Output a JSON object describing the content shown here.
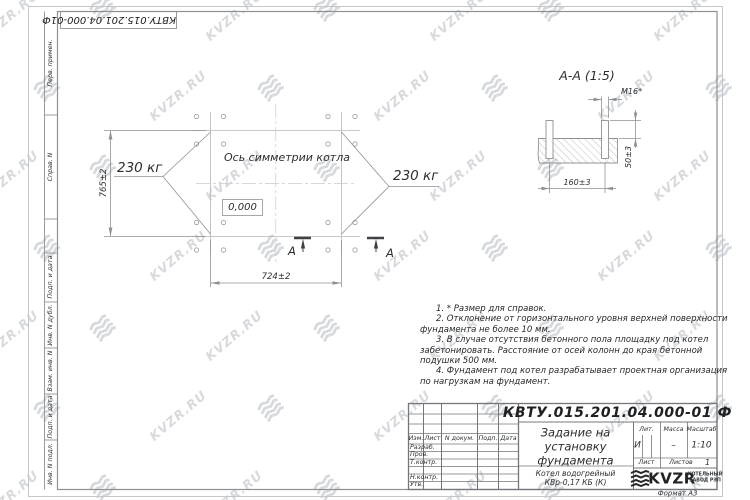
{
  "watermark": {
    "text": "KVZR.RU",
    "color": "#d7dadc"
  },
  "colors": {
    "line_gray": "#8e9296",
    "axis_gray": "#b3b7bb",
    "text_dark": "#2b2d2f"
  },
  "top_designation": "КВТУ.015.201.04.000-01Ф",
  "side_stamps": {
    "labels": [
      "Перв. примен.",
      "Справ. N",
      "Подп. и дата",
      "Инв. N дубл.",
      "Взам. инв. N",
      "Подп. и дата",
      "Инв. N подл."
    ]
  },
  "plan": {
    "symmetry_label": "Ось симметрии котла",
    "load_left": "230 кг",
    "load_right": "230 кг",
    "level_mark": "0,000",
    "width_dim": "724±2",
    "height_dim": "765±2",
    "section_mark": "А"
  },
  "section": {
    "title": "А-А (1:5)",
    "thread_label": "М16*",
    "spacing_dim": "160±3",
    "height_dim": "50±3"
  },
  "notes": {
    "items": [
      "1. * Размер для справок.",
      "2. Отклонение от горизонтального уровня верхней поверхности фундамента не более 10 мм.",
      "3. В случае отсутствия бетонного пола площадку под котел забетонировать. Расстояние от осей колонн до края бетонной подушки 500 мм.",
      "4. Фундамент под котел разрабатывает проектная организация по нагрузкам на фундамент."
    ]
  },
  "title_block": {
    "designation": "КВТУ.015.201.04.000-01 Ф",
    "doc_title_lines": [
      "Задание на",
      "установку",
      "фундамента"
    ],
    "product_lines": [
      "Котел водогрейный",
      "КВр-0,17 КБ (К)"
    ],
    "header_cols": [
      "Изм.",
      "Лист",
      "N докум.",
      "Подп.",
      "Дата"
    ],
    "rows": [
      "Разраб.",
      "Пров.",
      "Т.контр.",
      "Н.контр.",
      "Утв."
    ],
    "lit_label": "Лит.",
    "lit_value": "И",
    "mass_label": "Масса",
    "mass_value": "–",
    "scale_label": "Масштаб",
    "scale_value": "1:10",
    "sheet_label": "Лист",
    "sheets_label": "Листов",
    "sheets_value": "1",
    "org_name": "KVZR",
    "org_desc_lines": [
      "КОТЕЛЬНЫЙ",
      "ЗАВОД РЭП"
    ],
    "format": "Формат А3"
  }
}
